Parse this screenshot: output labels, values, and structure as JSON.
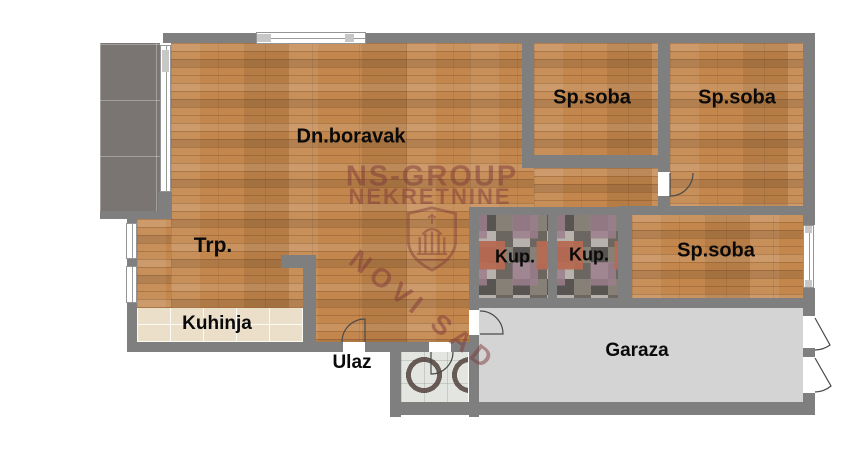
{
  "floor_plan": {
    "watermark": {
      "line1": "NS-GROUP",
      "line2": "NEKRETNINE",
      "line3": "NOVI SAD"
    },
    "rooms": {
      "living_room": "Dn.boravak",
      "bedroom_top_1": "Sp.soba",
      "bedroom_top_2": "Sp.soba",
      "bedroom_right": "Sp.soba",
      "dining": "Trp.",
      "kitchen": "Kuhinja",
      "entrance": "Ulaz",
      "bathroom_1": "Kup.",
      "bathroom_2": "Kup.",
      "garage": "Garaza"
    },
    "colors": {
      "background": "#ffffff",
      "wall": "#7f7f7f",
      "wood_floor": "#c3874e",
      "terrace_tile": "#7a7572",
      "kitchen_tile": "#ebdfca",
      "garage_floor": "#d4d4d4",
      "bath_tile_base": "#8f8882",
      "vestibule_tile": "#e3e6e0",
      "label_text": "#0a0a0a",
      "watermark": "#7d3a3a"
    }
  }
}
